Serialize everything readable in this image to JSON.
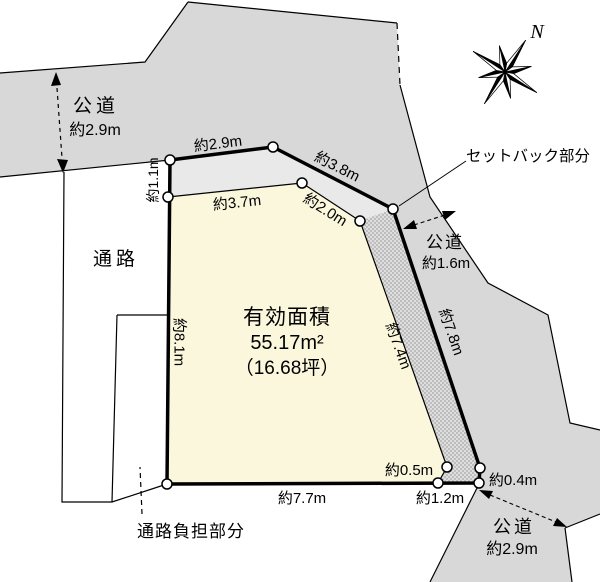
{
  "colors": {
    "road": "#d8d8d8",
    "strip_top": "#e9e9e9",
    "plot": "#fbf7dc",
    "line": "#000000"
  },
  "labels": {
    "road_left_name": "公道",
    "road_left_width": "約2.9m",
    "passage": "通路",
    "edge_left_top": "約1.1m",
    "edge_top": "約2.9m",
    "edge_top_diag": "約3.8m",
    "edge_inner_top": "約3.7m",
    "edge_inner_diag": "約2.0m",
    "setback": "セットバック部分",
    "road_right_name": "公道",
    "road_right_width": "約1.6m",
    "edge_left": "約8.1m",
    "edge_inner_right": "約7.4m",
    "edge_outer_right": "約7.8m",
    "area_title": "有効面積",
    "area_sqm": "55.17m²",
    "area_tsubo": "（16.68坪）",
    "edge_corner_05": "約0.5m",
    "edge_bottom_12": "約1.2m",
    "edge_corner_04": "約0.4m",
    "edge_bottom": "約7.7m",
    "passage_burden": "通路負担部分",
    "road_bottom_name": "公道",
    "road_bottom_width": "約2.9m",
    "north": "N"
  }
}
